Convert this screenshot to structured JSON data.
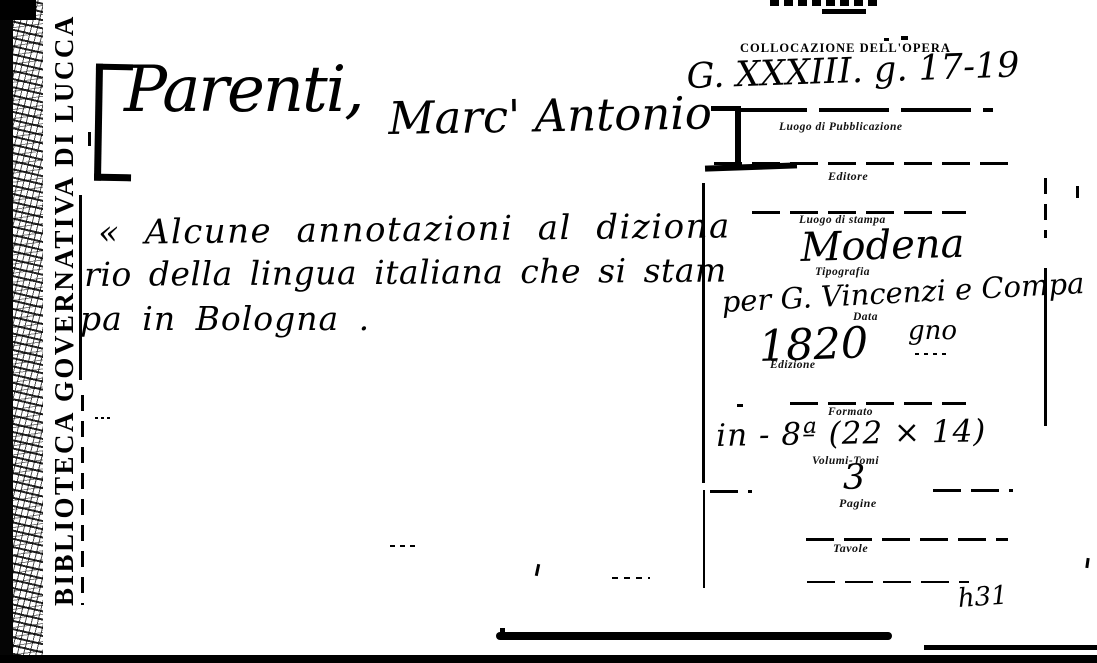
{
  "stamp": {
    "text": "BIBLIOTECA GOVERNATIVA DI LUCCA"
  },
  "heading": {
    "surname": "Parenti,",
    "forename": "Marc' Antonio"
  },
  "title": {
    "lines": [
      "« Alcune annotazioni al diziona",
      "rio della lingua italiana che si stam",
      "pa in Bologna ."
    ]
  },
  "form": {
    "collocazione_label": "COLLOCAZIONE DELL'OPERA",
    "collocazione_value": "G. XXXIII. g. 17-19",
    "luogo_pubblicazione_label": "Luogo di Pubblicazione",
    "editore_label": "Editore",
    "luogo_stampa_label": "Luogo di stampa",
    "luogo_stampa_value": "Modena",
    "tipografia_label": "Tipografia",
    "tipografia_value_line1": "per G. Vincenzi e Compa",
    "tipografia_value_line2": "gno",
    "data_label": "Data",
    "data_value": "1820",
    "edizione_label": "Edizione",
    "formato_label": "Formato",
    "formato_value": "in - 8ª (22 × 14)",
    "volumi_label": "Volumi-Tomi",
    "volumi_value": "3",
    "pagine_label": "Pagine",
    "tavole_label": "Tavole"
  },
  "notes": {
    "bottom_code": "h31"
  }
}
